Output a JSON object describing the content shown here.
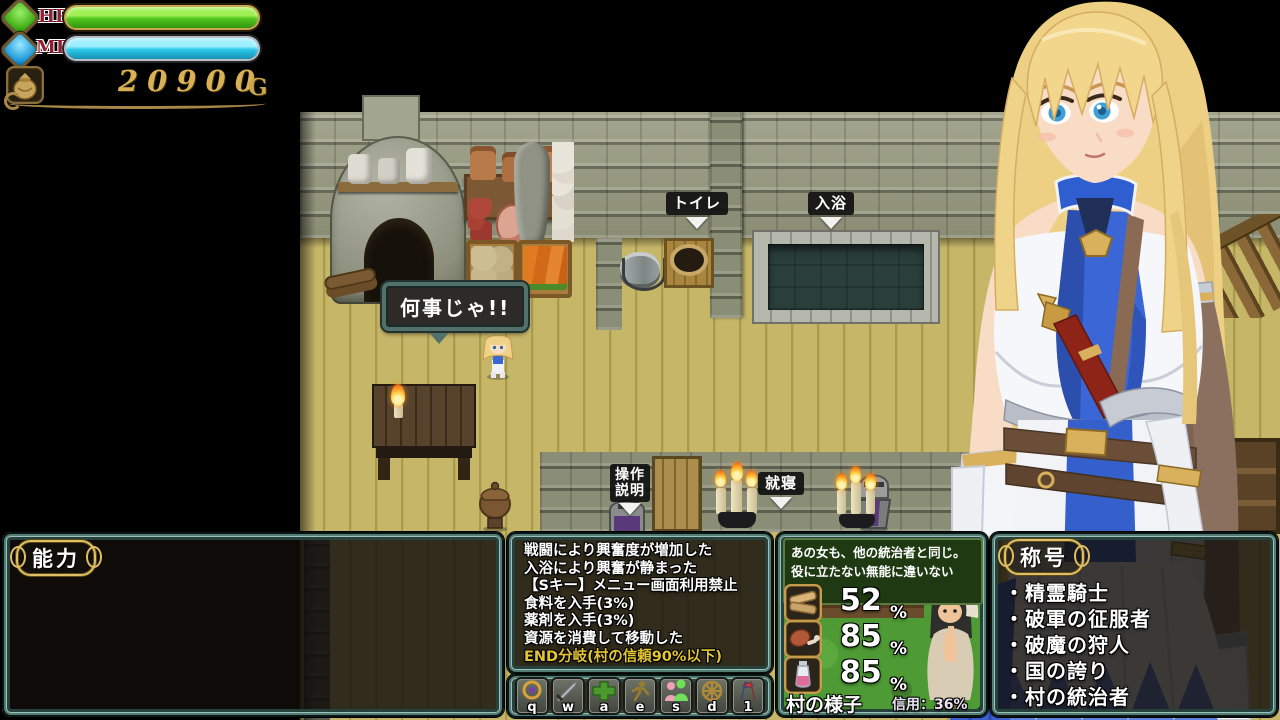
{
  "hud": {
    "hp_label": "HP",
    "mp_label": "MP",
    "gold_amount": "20900",
    "gold_unit": "G"
  },
  "map": {
    "bubble_text": "何事じゃ!!",
    "labels": {
      "toilet": "トイレ",
      "bath": "入浴",
      "controls": [
        "操作",
        "説明"
      ],
      "sleep": "就寝"
    }
  },
  "panels": {
    "ability": {
      "title": "能力"
    },
    "log": {
      "lines": [
        {
          "text": "戦闘により興奮度が増加した",
          "color": "#ffffff"
        },
        {
          "text": "入浴により興奮が静まった",
          "color": "#ffffff"
        },
        {
          "text": "【Sキー】メニュー画面利用禁止",
          "color": "#ffffff"
        },
        {
          "text": "食料を入手(3%)",
          "color": "#ffffff"
        },
        {
          "text": "薬剤を入手(3%)",
          "color": "#ffffff"
        },
        {
          "text": "資源を消費して移動した",
          "color": "#ffffff"
        },
        {
          "text": "END分岐(村の信頼90%以下)",
          "color": "#e2c531"
        }
      ]
    },
    "hotbar": {
      "keys": [
        {
          "key": "q",
          "icon": "amulet-icon"
        },
        {
          "key": "w",
          "icon": "sword-icon"
        },
        {
          "key": "a",
          "icon": "plus-icon"
        },
        {
          "key": "e",
          "icon": "run-icon"
        },
        {
          "key": "s",
          "icon": "couple-icon"
        },
        {
          "key": "d",
          "icon": "compass-icon"
        },
        {
          "key": "1",
          "icon": "flags-icon"
        }
      ]
    },
    "village": {
      "bubble_line1": "あの女も、他の統治者と同じ。",
      "bubble_line2": "役に立たない無能に違いないわ。",
      "resources": [
        {
          "icon": "wood-icon",
          "value": "52",
          "unit": "%"
        },
        {
          "icon": "meat-icon",
          "value": "85",
          "unit": "%"
        },
        {
          "icon": "potion-icon",
          "value": "85",
          "unit": "%"
        }
      ],
      "footer_label": "村の様子",
      "trust_text": "信用：36%"
    },
    "titles": {
      "title": "称号",
      "items": [
        "・精霊騎士",
        "・破軍の征服者",
        "・破魔の狩人",
        "・国の誇り",
        "・村の統治者"
      ]
    }
  },
  "colors": {
    "hp_fill": "#5ed321",
    "mp_fill": "#2cc9ea",
    "gold_text": "#d8b156",
    "log_highlight": "#e2c531",
    "panel_border": "#537d74",
    "village_bubble_bg": "#1f3a12"
  }
}
